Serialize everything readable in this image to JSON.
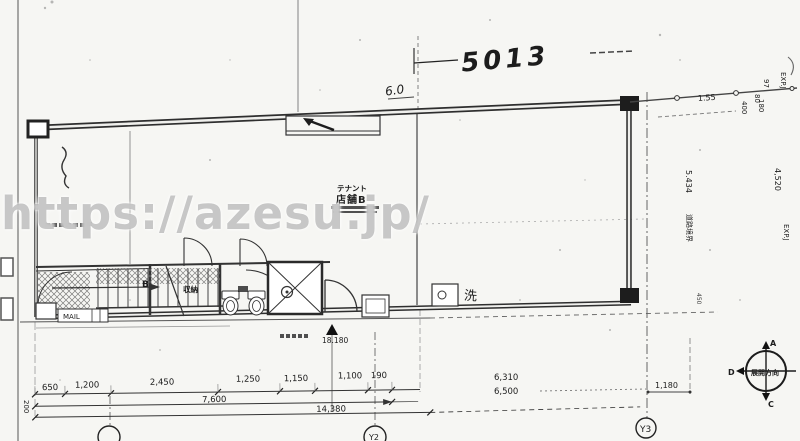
{
  "watermark": "https://azesu.jp/",
  "handwritten": {
    "dim_top": "5013",
    "dim_small": "6.0"
  },
  "labels": {
    "tenant_type": "テナント",
    "tenant_name": "店舗B",
    "storage": "収納",
    "stair": "B",
    "mail": "MAIL",
    "wash": "洗",
    "level": "18.180",
    "boundary": "道路境界"
  },
  "dims": {
    "top_right": {
      "d155": "1.55",
      "d97": "97",
      "d80": "80",
      "d400": "400",
      "d180": "180",
      "exp_upper": "EXP.J",
      "exp_lower": "EXP.J",
      "v_right": "4,520",
      "v_mid": "5.434",
      "small_right": "450"
    },
    "bottom": {
      "segments": [
        "650",
        "1,200",
        "2,450",
        "1,250",
        "1,150",
        "1,100",
        "190"
      ],
      "sub_total": "7,600",
      "total": "14,380",
      "left_offset": "200"
    },
    "bottom_right": {
      "a": "6,310",
      "b": "6,500",
      "c": "1,180"
    }
  },
  "grid": {
    "y2": "Y2",
    "y3": "Y3"
  },
  "compass": {
    "top": "A",
    "bottom": "C",
    "left": "D",
    "label": "展開方向"
  }
}
